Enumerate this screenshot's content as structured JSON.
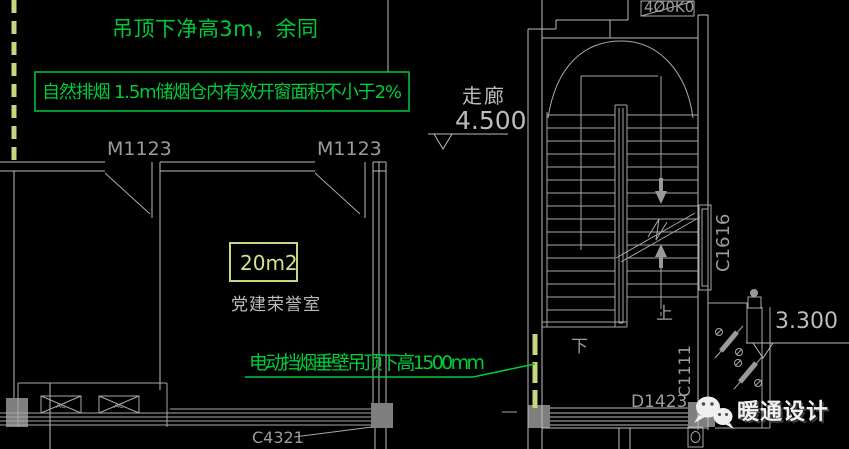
{
  "colors": {
    "background": "#000000",
    "cad_line": "#a8a8a8",
    "annotation_green": "#00cc3a",
    "smoke_barrier_yellow_green": "#c9d67c",
    "label_gray": "#9b9b9b",
    "column_fill": "#7f7f7f",
    "watermark_white": "#f0f0f0"
  },
  "notes": {
    "ceiling": "吊顶下净高3m，余同",
    "natural_smoke": "自然排烟  1.5m储烟仓内有效开窗面积不小于2%",
    "smoke_barrier": "电动挡烟垂壁吊顶下高1500mm"
  },
  "corridor": {
    "name": "走廊",
    "elevation": "4.500"
  },
  "room": {
    "area": "20m2",
    "name": "党建荣誉室"
  },
  "stair": {
    "up": "上",
    "down": "下"
  },
  "tags": {
    "door_left": "M1123",
    "door_right": "M1123",
    "window_bottom": "C4321",
    "stair_window": "C1616",
    "stair_door": "D1423",
    "right_window": "C1111",
    "right_elevation": "3.300",
    "top_partial": "4Ø0K0",
    "vent_left": "AC",
    "vent_right": "AC"
  },
  "watermark": {
    "label": "暖通设计"
  }
}
